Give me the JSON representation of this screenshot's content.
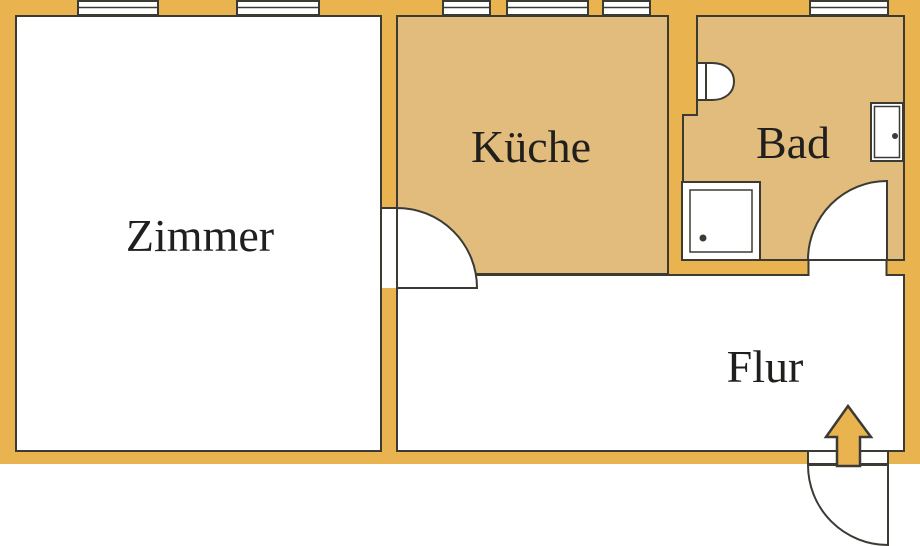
{
  "rooms": [
    {
      "id": "zimmer",
      "label": "Zimmer"
    },
    {
      "id": "kueche",
      "label": "Küche"
    },
    {
      "id": "bad",
      "label": "Bad"
    },
    {
      "id": "flur",
      "label": "Flur"
    }
  ],
  "fixtures": [
    {
      "name": "toilet"
    },
    {
      "name": "shower-tray"
    },
    {
      "name": "wash-basin"
    },
    {
      "name": "entrance-arrow"
    }
  ],
  "windows": {
    "count": 6
  },
  "doors": [
    "zimmer-door",
    "bad-door",
    "entrance-door"
  ],
  "colors": {
    "wall": "#e9b44f",
    "floor": "#e1bc7c",
    "outline": "#3b3a33",
    "room": "#ffffff",
    "text": "#201f1d"
  }
}
